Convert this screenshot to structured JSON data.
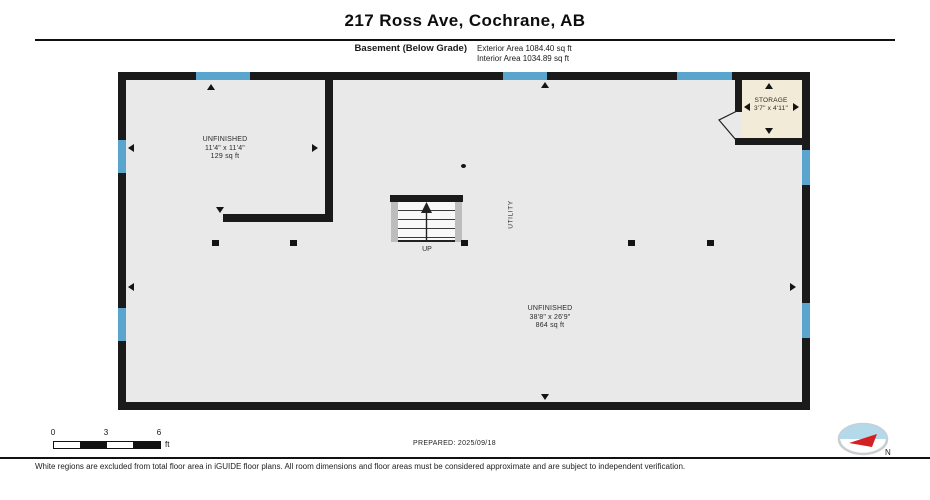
{
  "header": {
    "title": "217 Ross Ave, Cochrane, AB",
    "floor_label": "Basement (Below Grade)",
    "exterior_area": "Exterior Area 1084.40 sq ft",
    "interior_area": "Interior Area 1034.89 sq ft"
  },
  "floorplan": {
    "rooms": [
      {
        "name": "UNFINISHED",
        "dims": "11'4\" x 11'4\"",
        "area": "129 sq ft"
      },
      {
        "name": "UNFINISHED",
        "dims": "38'8\" x 26'9\"",
        "area": "864 sq ft"
      },
      {
        "name": "STORAGE",
        "dims": "3'7\" x 4'11\""
      }
    ],
    "stairs": {
      "direction_label": "UP"
    },
    "utility_label": "UTILITY"
  },
  "scale_bar": {
    "ticks": [
      "0",
      "3",
      "6"
    ],
    "unit_label": "ft"
  },
  "footer": {
    "prepared_label": "PREPARED: 2025/09/18",
    "disclaimer": "White regions are excluded from total floor area in iGUIDE floor plans. All room dimensions and floor areas must be considered approximate and are subject to independent verification.",
    "compass_north_label": "N"
  },
  "colors": {
    "wall": "#1a1a1a",
    "floor": "#e9e9e9",
    "window": "#5aa5cd",
    "storage_floor": "#f2ebd8",
    "compass_blue": "#b4d9ea",
    "compass_red": "#d42020"
  }
}
